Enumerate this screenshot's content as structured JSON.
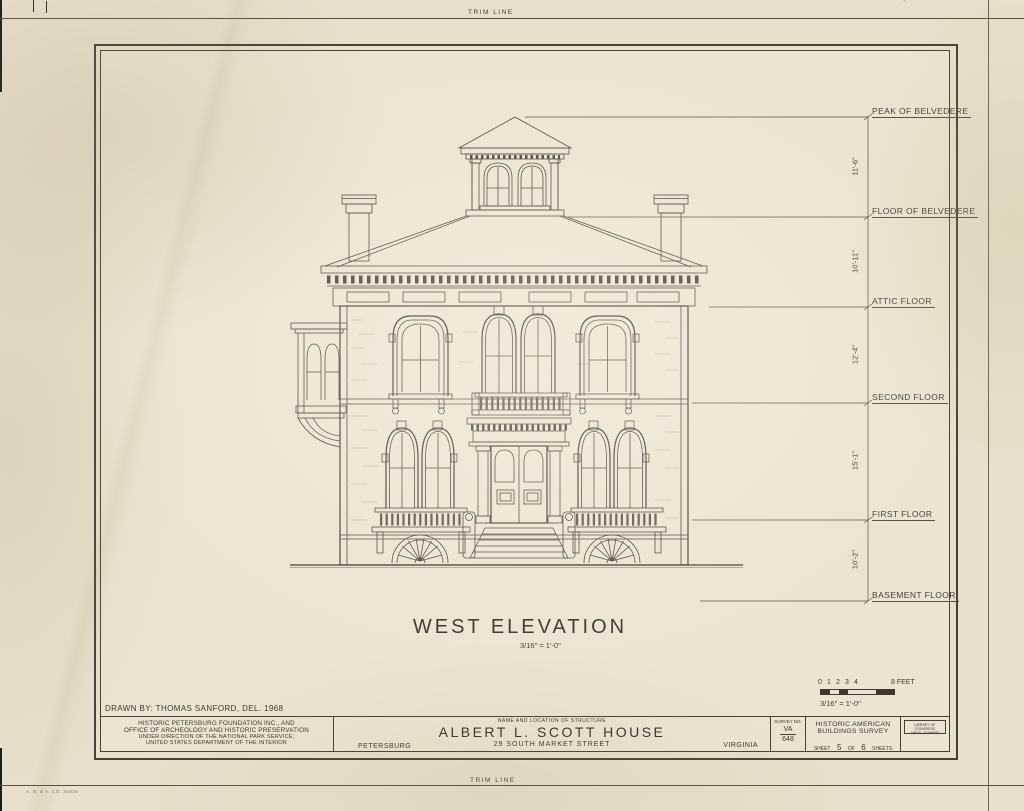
{
  "trim": {
    "top": "TRIM LINE",
    "bottom": "TRIM LINE"
  },
  "elevation": {
    "title": "WEST ELEVATION",
    "scale_note": "3/16\" = 1'-0\"",
    "levels": [
      {
        "label": "PEAK OF BELVEDERE"
      },
      {
        "label": "FLOOR OF BELVEDERE"
      },
      {
        "label": "ATTIC FLOOR"
      },
      {
        "label": "SECOND FLOOR"
      },
      {
        "label": "FIRST FLOOR"
      },
      {
        "label": "BASEMENT FLOOR"
      }
    ],
    "dimensions": [
      "11'-6\"",
      "10'-11\"",
      "12'-4\"",
      "15'-1\"",
      "10'-2\""
    ]
  },
  "scale_bar": {
    "ticks": [
      "0",
      "1",
      "2",
      "3",
      "4"
    ],
    "feet_label": "8 FEET",
    "ratio": "3/16\" = 1'-0\""
  },
  "title_block": {
    "drawn_by": "DRAWN BY: THOMAS SANFORD, DEL. 1968",
    "sponsor_line1": "HISTORIC PETERSBURG FOUNDATION INC., AND",
    "sponsor_line2": "OFFICE OF ARCHEOLOGY AND HISTORIC PRESERVATION",
    "sponsor_line3": "UNDER DIRECTION OF THE NATIONAL PARK SERVICE,",
    "sponsor_line4": "UNITED STATES DEPARTMENT OF THE INTERIOR",
    "city": "PETERSBURG",
    "name_header": "NAME AND LOCATION OF STRUCTURE",
    "structure_name": "ALBERT L. SCOTT HOUSE",
    "address": "29 SOUTH MARKET STREET",
    "state": "VIRGINIA",
    "survey_label": "SURVEY NO.",
    "survey_state": "VA",
    "survey_number": "648",
    "habs_line1": "HISTORIC AMERICAN",
    "habs_line2": "BUILDINGS SURVEY",
    "sheet_word": "SHEET",
    "sheet_number": "5",
    "of_word": "OF",
    "sheet_total": "6",
    "sheets_word": "SHEETS",
    "loc_line1": "LIBRARY OF CONGRESS",
    "loc_line2": "NEGS. NUMBER"
  },
  "printer_mark": "A. B. & A. CO.  25936"
}
